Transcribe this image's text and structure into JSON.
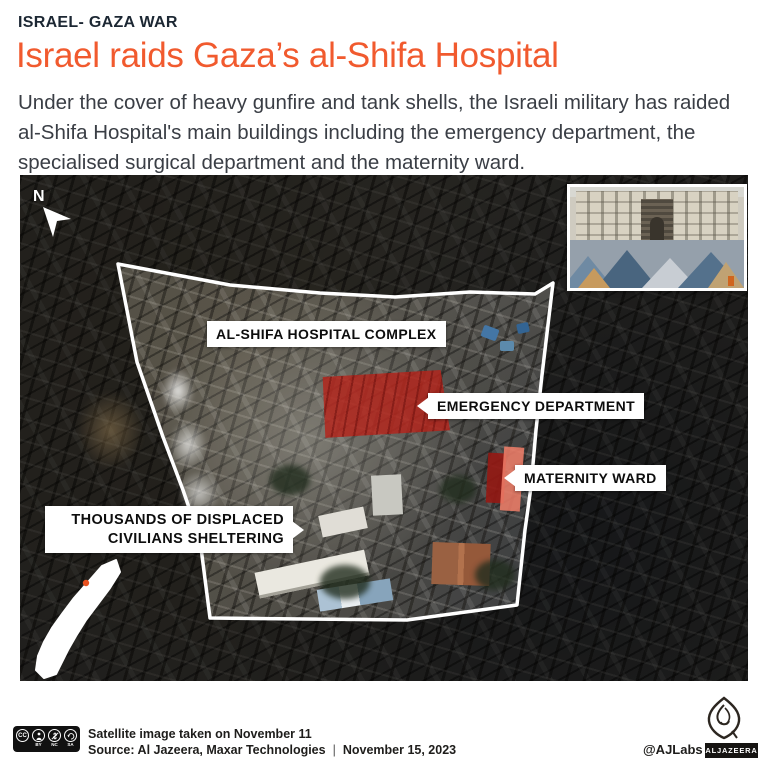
{
  "meta": {
    "accent_color": "#f15a2e",
    "kicker_color": "#1c2733",
    "body_text_color": "#3a3e45",
    "highlight_red": "#a82118",
    "maternity_salmon": "#e07662",
    "locator_dot_color": "#e8511f",
    "outline_color": "#ffffff"
  },
  "header": {
    "kicker": "ISRAEL- GAZA WAR",
    "title": "Israel raids Gaza’s al-Shifa Hospital",
    "description": "Under the cover of heavy gunfire and tank shells, the Israeli military has raided al-Shifa Hospital's main buildings including the emergency department, the specialised surgical department and the maternity ward."
  },
  "map": {
    "compass": "N",
    "labels": {
      "complex": "AL-SHIFA HOSPITAL COMPLEX",
      "emergency": "EMERGENCY DEPARTMENT",
      "maternity": "MATERNITY WARD",
      "displaced_line1": "THOUSANDS OF DISPLACED",
      "displaced_line2": "CIVILIANS SHELTERING"
    },
    "icons": {
      "north_arrow": "north-arrow",
      "gaza_strip_locator": "gaza-strip-outline",
      "inset_photo": "hospital-photo-inset"
    }
  },
  "footer": {
    "license": {
      "cc": "CC",
      "by": "BY",
      "nc": "NC",
      "sa": "SA"
    },
    "caption_line1": "Satellite image taken on November 11",
    "source": "Source: Al Jazeera, Maxar Technologies",
    "separator": "|",
    "date": "November 15, 2023",
    "handle": "@AJLabs",
    "brand": "ALJAZEERA"
  }
}
